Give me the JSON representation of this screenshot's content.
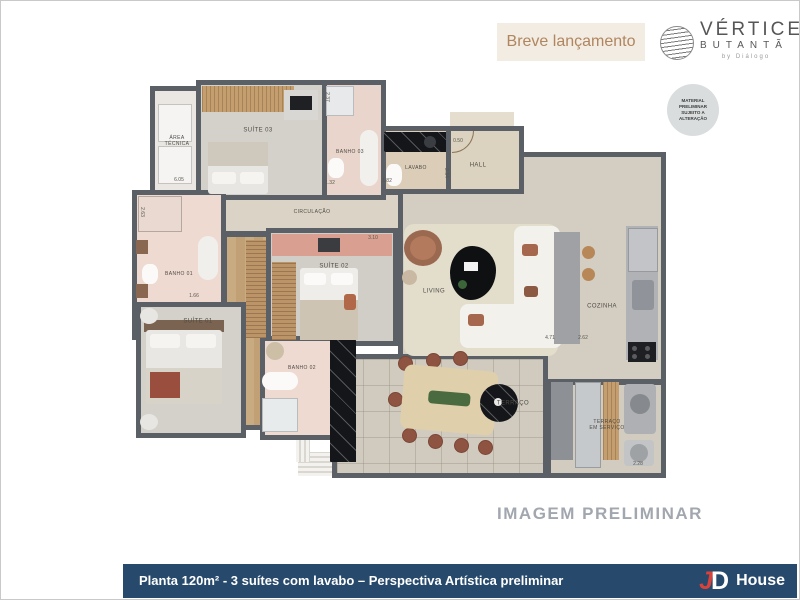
{
  "header": {
    "launch_badge": "Breve lançamento",
    "brand": {
      "name": "VÉRTICE",
      "sub": "BUTANTÃ",
      "byline": "by Diálogo"
    },
    "disclaimer": "MATERIAL\nPRELIMINAR\nSUJEITO A\nALTERAÇÃO"
  },
  "floorplan": {
    "rooms": {
      "area_tecnica": "ÁREA\nTÉCNICA",
      "suite03": "SUÍTE 03",
      "banho03": "BANHO 03",
      "lavabo": "LAVABO",
      "hall": "HALL",
      "circulacao": "CIRCULAÇÃO",
      "banho01": "BANHO 01",
      "suite02": "SUÍTE 02",
      "suite01": "SUÍTE 01",
      "banho02": "BANHO 02",
      "living": "LIVING",
      "cozinha": "COZINHA",
      "terraco": "TERRAÇO",
      "terraco_servico": "TERRAÇO\nEM SERVIÇO"
    },
    "dimensions": [
      {
        "value": "2.37"
      },
      {
        "value": "6.05"
      },
      {
        "value": "1.32"
      },
      {
        "value": "1.82"
      },
      {
        "value": "2.34"
      },
      {
        "value": "0.50"
      },
      {
        "value": "2.63"
      },
      {
        "value": "1.66"
      },
      {
        "value": "3.10"
      },
      {
        "value": "4.71"
      },
      {
        "value": "2.62"
      },
      {
        "value": "2.28"
      }
    ]
  },
  "watermark": "IMAGEM PRELIMINAR",
  "footer": {
    "caption": "Planta 120m² - 3 suítes com lavabo – Perspectiva Artística preliminar",
    "brand": {
      "j": "J",
      "d": "D",
      "name": "House"
    }
  },
  "colors": {
    "wall": "#5b5f66",
    "navy_bar": "#27496b",
    "launch_badge_bg": "#f2ece2",
    "launch_badge_text": "#b08560",
    "watermark_text": "#a2a7af",
    "logo_red": "#d8423b"
  }
}
